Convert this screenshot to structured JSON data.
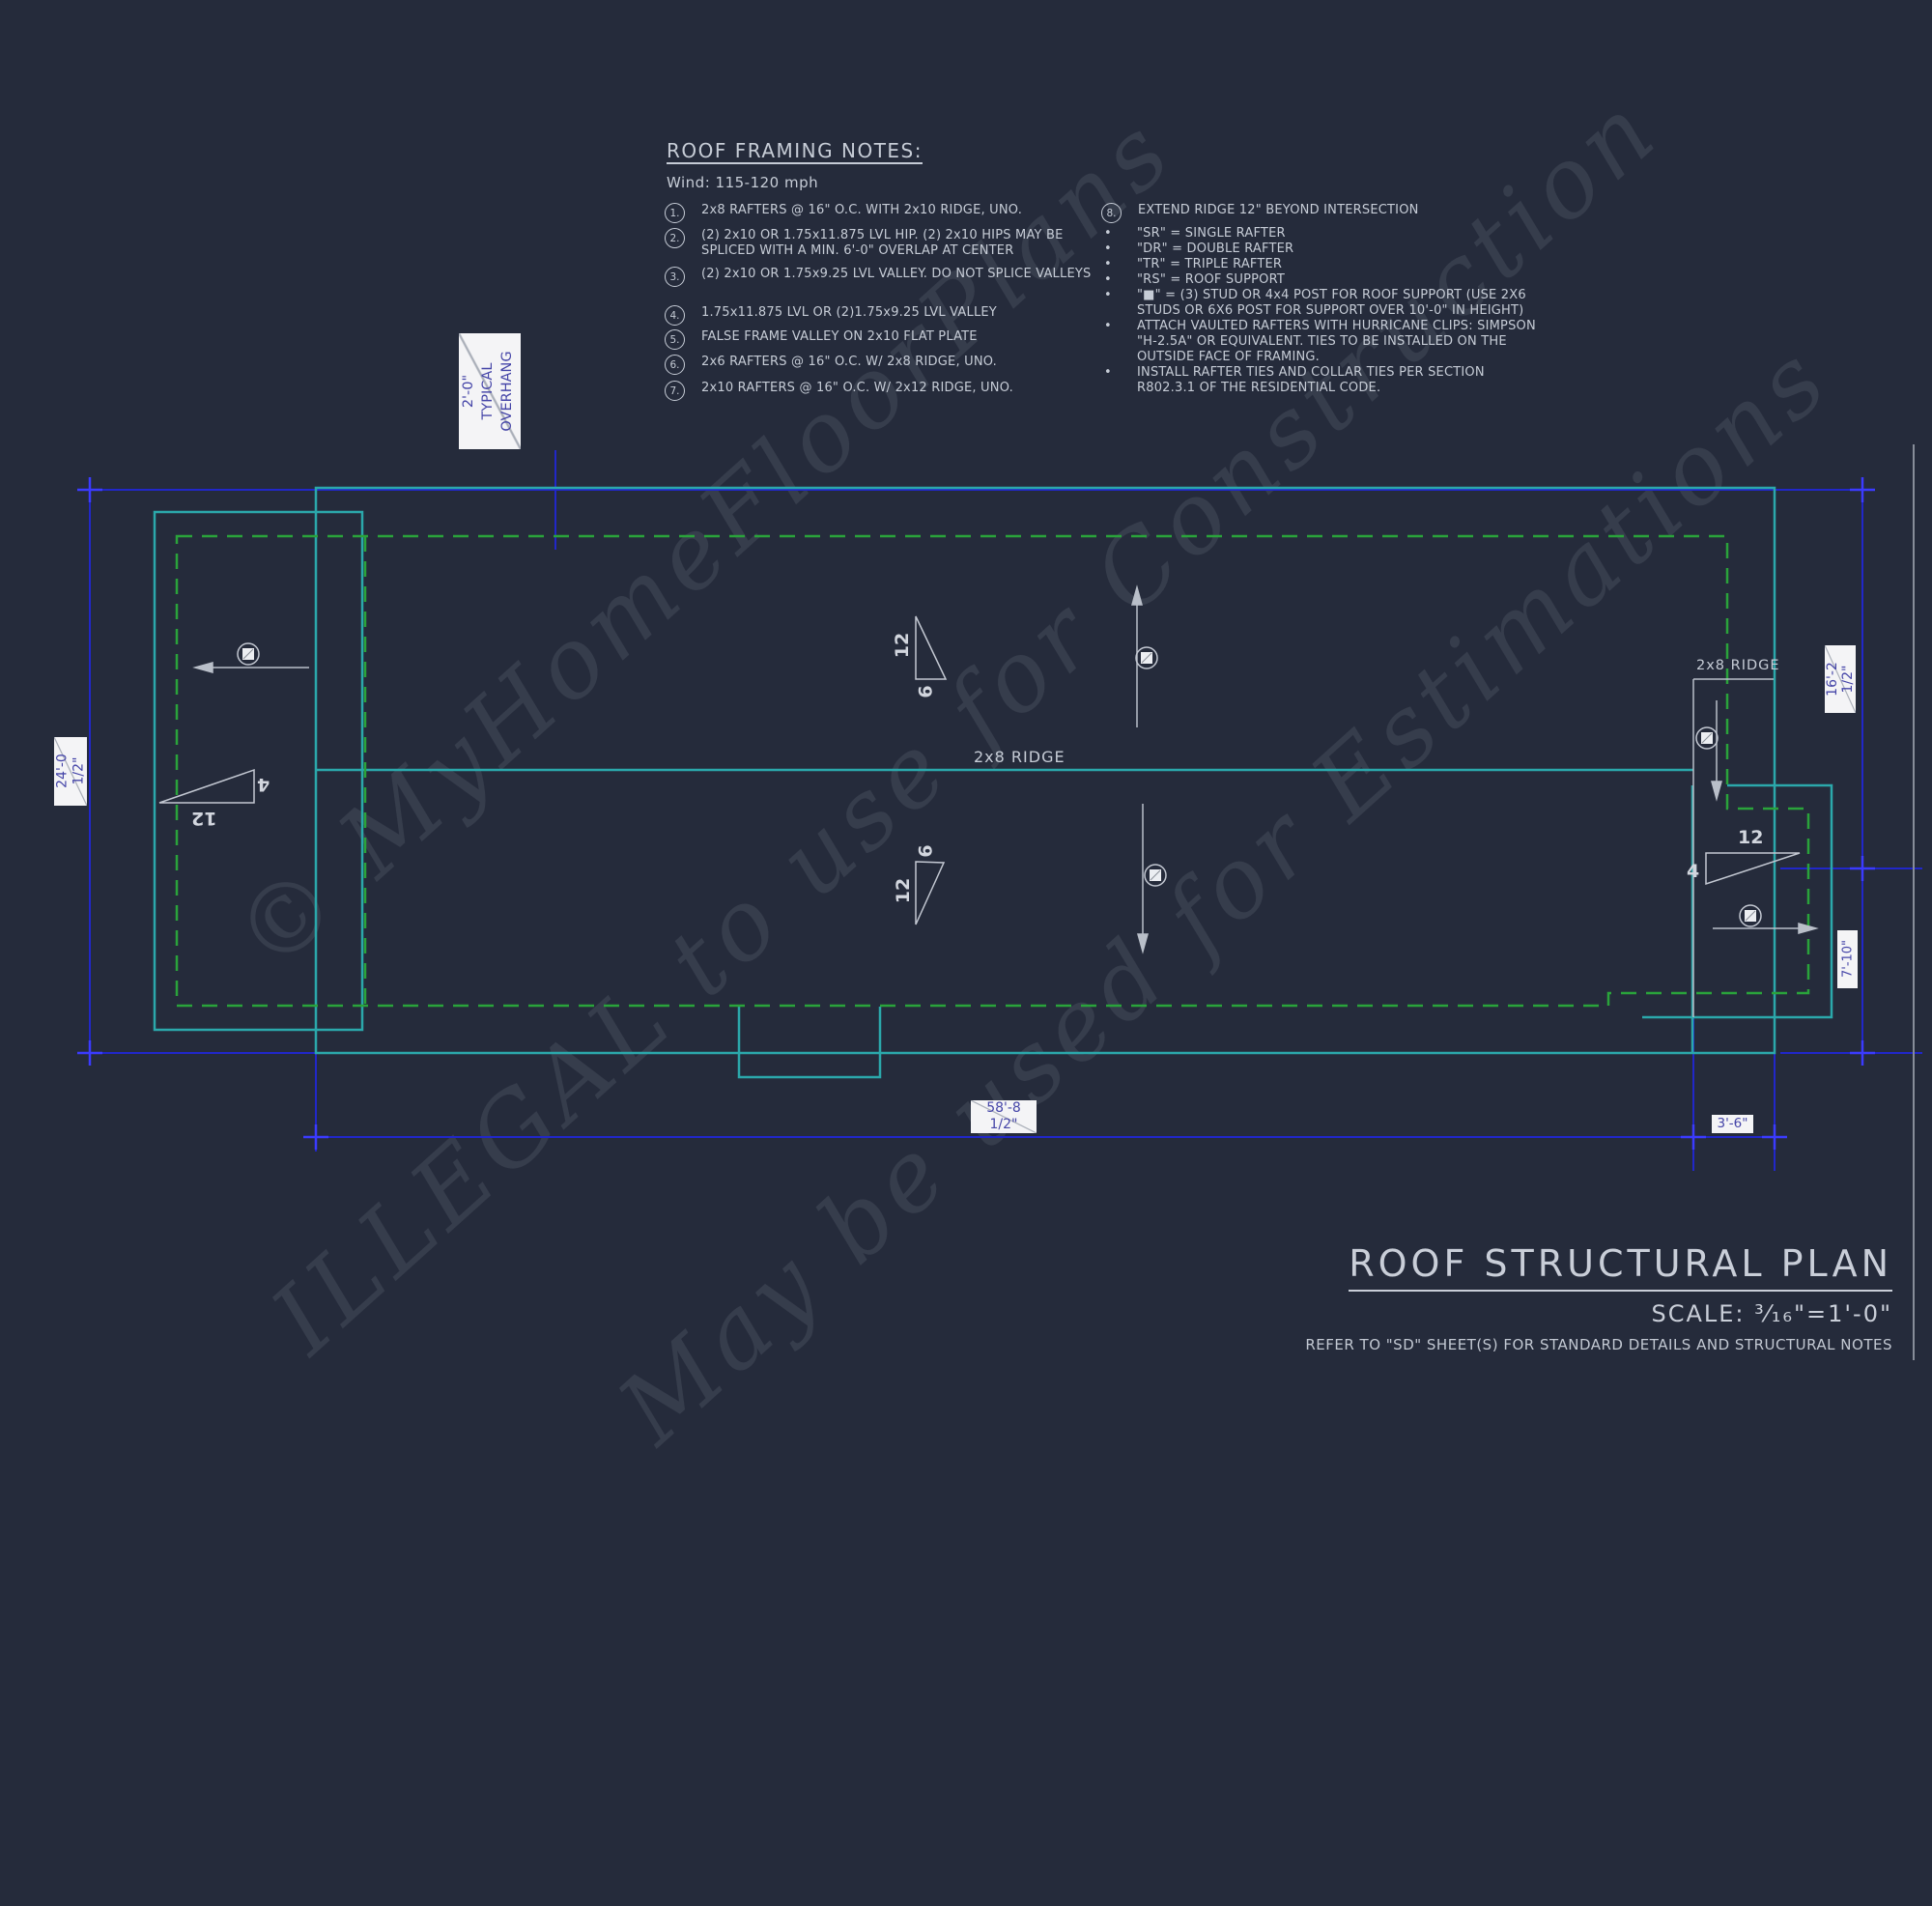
{
  "notes": {
    "title": "ROOF FRAMING NOTES:",
    "wind": "Wind: 115-120 mph",
    "bullet_char": "•",
    "items": [
      {
        "num": "1.",
        "text": "2x8 RAFTERS @ 16\" O.C. WITH 2x10 RIDGE, UNO."
      },
      {
        "num": "2.",
        "text": "(2) 2x10 OR 1.75x11.875 LVL HIP. (2) 2x10 HIPS MAY BE SPLICED WITH A MIN. 6'-0\" OVERLAP AT CENTER"
      },
      {
        "num": "3.",
        "text": "(2) 2x10 OR 1.75x9.25 LVL VALLEY. DO NOT SPLICE VALLEYS"
      },
      {
        "num": "4.",
        "text": "1.75x11.875 LVL OR (2)1.75x9.25 LVL VALLEY"
      },
      {
        "num": "5.",
        "text": "FALSE FRAME VALLEY ON 2x10 FLAT PLATE"
      },
      {
        "num": "6.",
        "text": "2x6 RAFTERS @ 16\" O.C. W/ 2x8 RIDGE, UNO."
      },
      {
        "num": "7.",
        "text": "2x10 RAFTERS @ 16\" O.C. W/ 2x12 RIDGE, UNO."
      }
    ],
    "item8": {
      "num": "8.",
      "text": "EXTEND RIDGE 12\" BEYOND INTERSECTION"
    },
    "bullets": [
      "\"SR\"  = SINGLE RAFTER",
      "\"DR\" = DOUBLE RAFTER",
      "\"TR\" = TRIPLE RAFTER",
      "\"RS\" = ROOF SUPPORT",
      "\"■\" = (3) STUD OR 4x4 POST FOR ROOF SUPPORT (USE 2X6 STUDS OR 6X6 POST FOR SUPPORT OVER 10'-0\" IN HEIGHT)",
      "ATTACH VAULTED RAFTERS WITH HURRICANE CLIPS: SIMPSON \"H-2.5A\" OR EQUIVALENT. TIES TO BE INSTALLED ON THE OUTSIDE FACE OF FRAMING.",
      "INSTALL RAFTER TIES AND COLLAR TIES PER SECTION R802.3.1 OF THE  RESIDENTIAL CODE."
    ]
  },
  "plan": {
    "overhang": {
      "l1": "2'-0\"",
      "l2": "TYPICAL",
      "l3": "OVERHANG"
    },
    "dims": {
      "d24": {
        "l1": "24'-0",
        "l2": "1/2\""
      },
      "d16": {
        "l1": "16'-2",
        "l2": "1/2\""
      },
      "d710": "7'-10\"",
      "d588": {
        "l1": "58'-8",
        "l2": "1/2\""
      },
      "d36": "3'-6\""
    },
    "ridge_main": "2x8 RIDGE",
    "ridge_right": "2x8 RIDGE",
    "slopes": {
      "left": {
        "long": "12",
        "short": "4"
      },
      "mid_upper": {
        "long": "12",
        "short": "6"
      },
      "mid_lower": {
        "long": "12",
        "short": "6"
      },
      "right": {
        "long": "12",
        "short": "4"
      }
    }
  },
  "watermark": {
    "line1": "© MyHomeFloorPlans",
    "line2": "ILLEGAL to use for Construction",
    "line3": "May be used for Estimations"
  },
  "title_block": {
    "title": "ROOF STRUCTURAL PLAN",
    "scale_label": "SCALE:",
    "scale_value": "³⁄₁₆\"=1'-0\"",
    "note": "REFER TO \"SD\" SHEET(S) FOR STANDARD DETAILS AND STRUCTURAL NOTES"
  },
  "colors": {
    "background": "#252b3b",
    "dimension_blue": "#2127c9",
    "dimension_tick_blue": "#3b3bff",
    "roof_outline_cyan": "#2ba8ab",
    "wall_dashed_green": "#2aa33b",
    "drawing_gray": "#c3c8d2",
    "label_text_blue": "#4545a8",
    "label_box_bg": "#f4f4f6"
  }
}
